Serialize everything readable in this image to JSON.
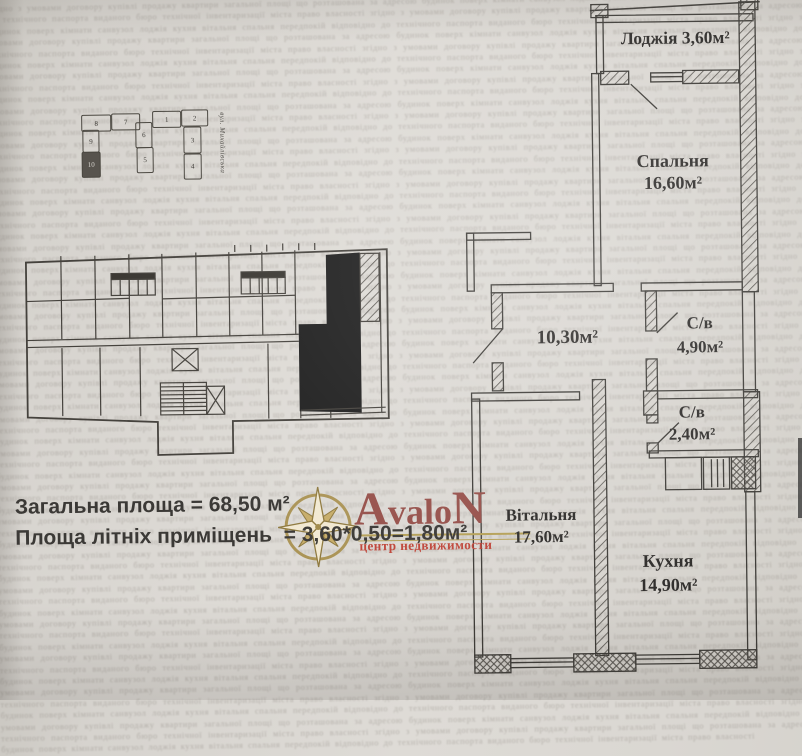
{
  "floor_plan": {
    "rooms": {
      "loggia": {
        "label": "Лоджія",
        "area": "3,60м²"
      },
      "bedroom": {
        "label": "Спальня",
        "area": "16,60м²"
      },
      "hall": {
        "area": "10,30м²"
      },
      "bath1": {
        "label": "С/в",
        "area": "4,90м²"
      },
      "bath2": {
        "label": "С/в",
        "area": "2,40м²"
      },
      "living": {
        "label": "Вітальня",
        "area": "17,60м²"
      },
      "kitchen": {
        "label": "Кухня",
        "area": "14,90м²"
      }
    }
  },
  "summary": {
    "line1": "Загальна площа = 68,50 м²",
    "line2_label": "Площа літніх приміщень ",
    "line2_value": " = 3,60*0,50=1,80м²"
  },
  "site_plan": {
    "street_label": "вул. Михайлівська",
    "blocks": [
      {
        "n": "8"
      },
      {
        "n": "7"
      },
      {
        "n": "1"
      },
      {
        "n": "2"
      },
      {
        "n": "6"
      },
      {
        "n": "9"
      },
      {
        "n": "3"
      },
      {
        "n": "10"
      },
      {
        "n": "5"
      },
      {
        "n": "4"
      }
    ]
  },
  "logo": {
    "first": "A",
    "mid": "valo",
    "last": "N",
    "tagline": "центр недвижимости",
    "colors": {
      "gold": "#b5a057",
      "red": "#96504a",
      "tagline_red": "#bf463a"
    }
  },
  "noise": {
    "text": "згідно з умовами договору купівлі продажу квартири загальної площі що розташована за адресою будинок поверх кімнати санвузол лоджія кухня вітальня спальня передпокій відповідно до технічного паспорта виданого бюро технічної інвентаризації міста право власності ",
    "repeat": 44
  }
}
